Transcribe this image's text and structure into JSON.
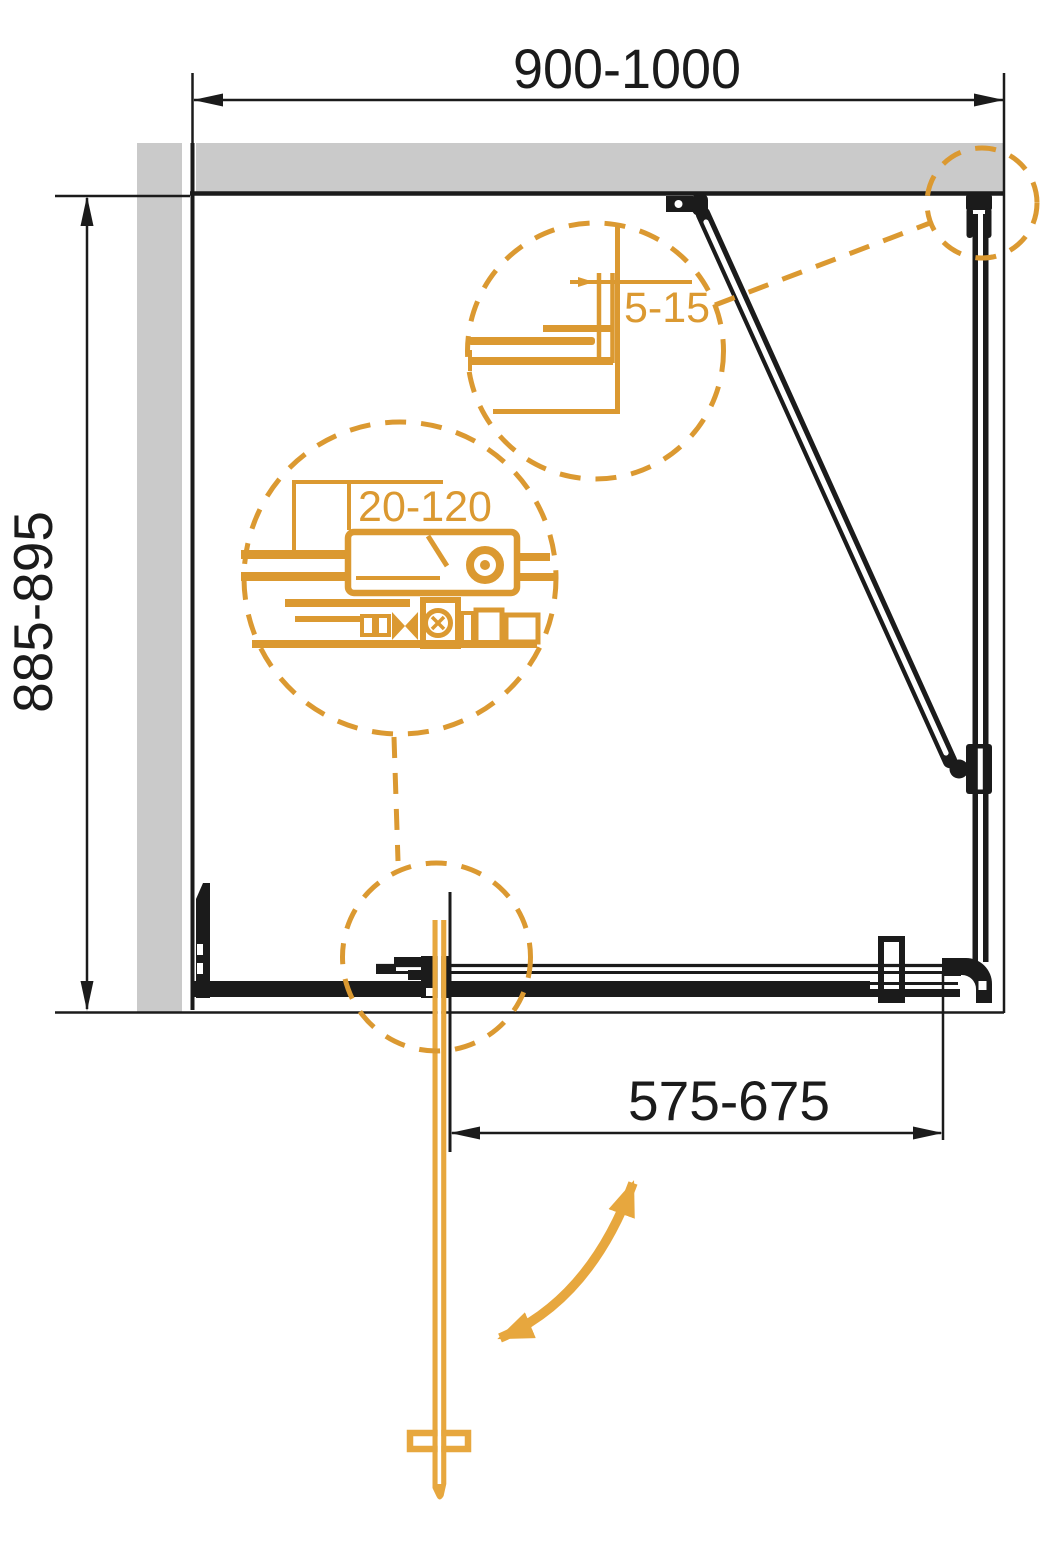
{
  "diagram": {
    "dimensions": {
      "overall_width": "900-1000",
      "overall_depth": "885-895",
      "door_opening": "575-675"
    },
    "callouts": {
      "wall_profile_gap": "5-15",
      "bracket_adjustment": "20-120"
    },
    "colors": {
      "accent_orange": "#DB9931",
      "door_orange": "#E7A73E",
      "wall_gray": "#CACACA",
      "line_black": "#1B1B1B"
    }
  }
}
